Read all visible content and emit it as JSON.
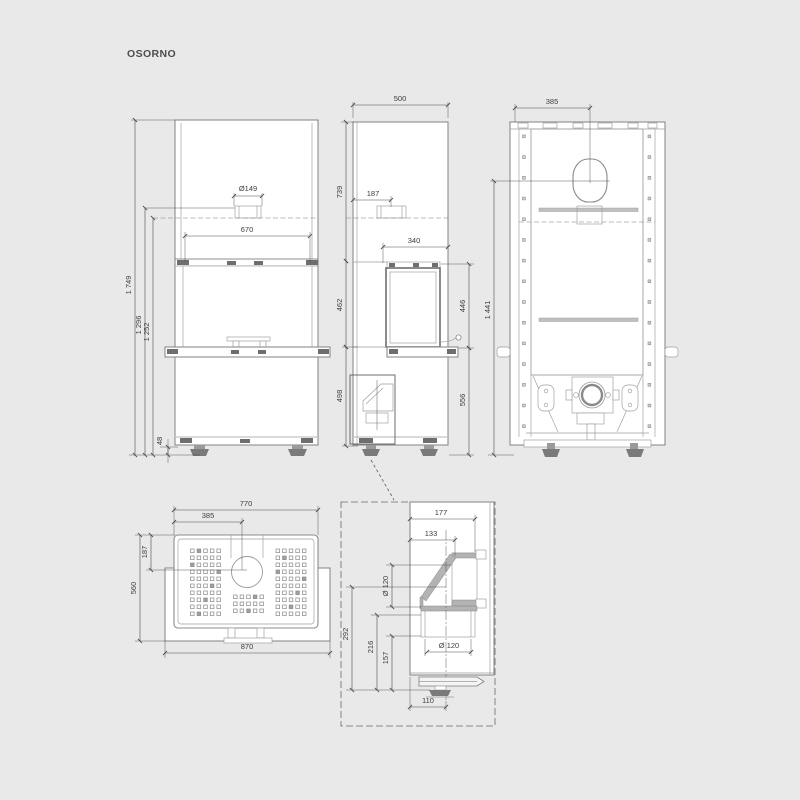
{
  "title": "OSORNO",
  "colors": {
    "background": "#e9e9e9",
    "line": "#8c8c8c",
    "dimension": "#4a4a4a"
  },
  "views": {
    "front": {
      "dims": {
        "flue_d": "Ø149",
        "opening_w": "670",
        "total_h": "1 749",
        "flue_top_h": "1 296",
        "flue_center_h": "1 252",
        "foot_h": "48"
      }
    },
    "side": {
      "dims": {
        "depth": "500",
        "upper_h": "739",
        "flue_off": "187",
        "front_d": "340",
        "door_h_left": "462",
        "door_h_right": "446",
        "base_h_left": "498",
        "base_h_right": "556"
      }
    },
    "rear": {
      "dims": {
        "flue_off": "385",
        "conn_h": "1 441"
      }
    },
    "top": {
      "dims": {
        "body_w": "770",
        "flue_x": "385",
        "flue_y": "187",
        "depth": "560",
        "shelf_w": "870"
      }
    },
    "detail": {
      "dims": {
        "depth": "177",
        "inner_d": "133",
        "pipe_d": "Ø 120",
        "c292": "292",
        "c216": "216",
        "c157": "157",
        "duct_d": "Ø 120",
        "off110": "110"
      }
    }
  }
}
